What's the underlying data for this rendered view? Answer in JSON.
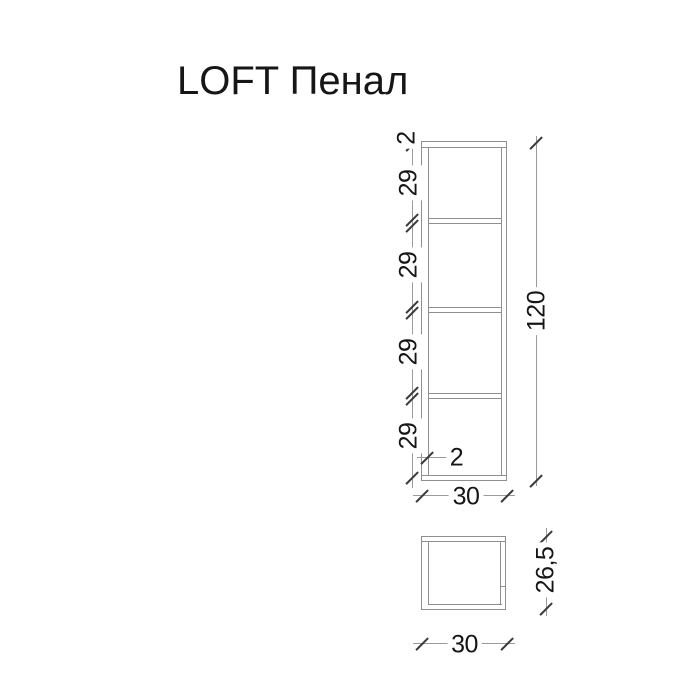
{
  "title": "LOFT Пенал",
  "colors": {
    "background": "#ffffff",
    "drawing_line": "#8f8f8f",
    "dimension_line": "#9a9a9a",
    "tick": "#3a3a3a",
    "text": "#161616"
  },
  "front_view": {
    "dimensions": {
      "top_panel_thickness": "2",
      "section_heights": [
        "29",
        "29",
        "29",
        "29"
      ],
      "total_height": "120",
      "width": "30",
      "side_wall_thickness": "2"
    }
  },
  "side_view": {
    "dimensions": {
      "width": "30",
      "depth": "26,5"
    }
  }
}
